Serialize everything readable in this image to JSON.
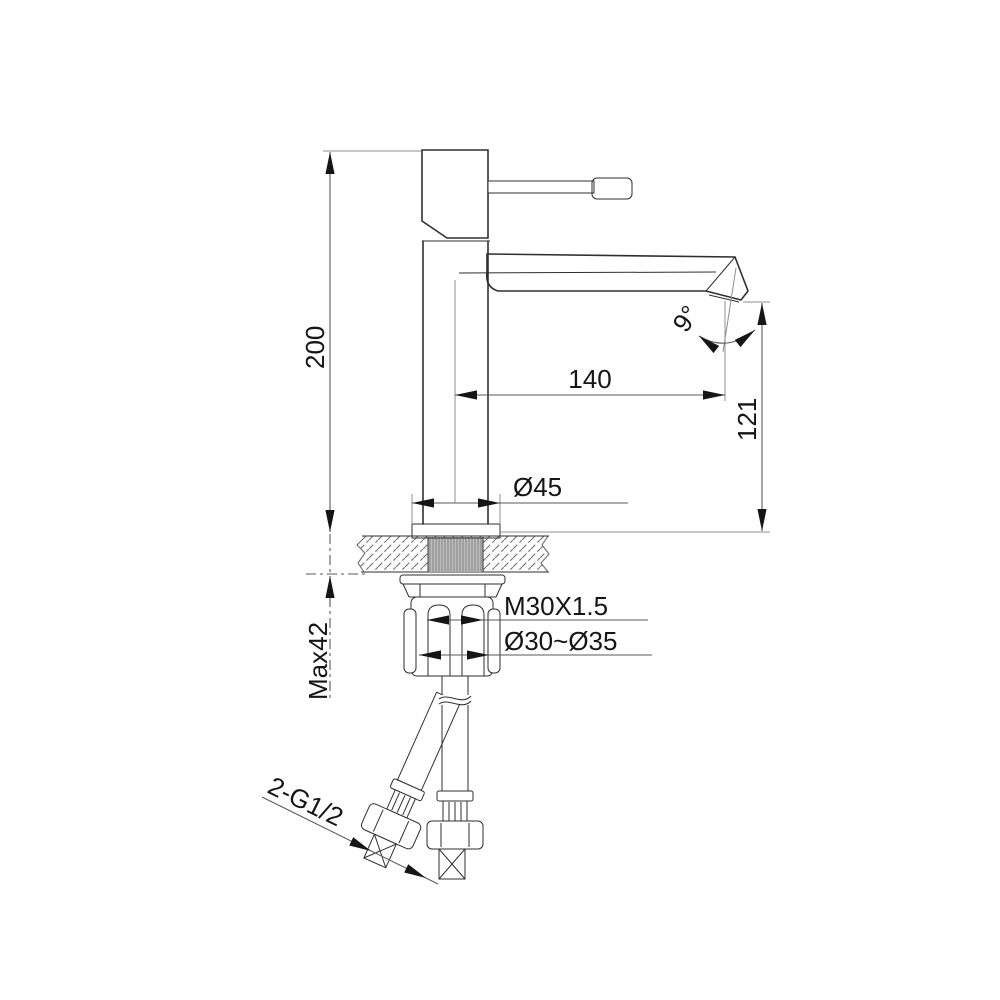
{
  "drawing": {
    "type": "technical-diagram",
    "subject": "single-lever basin mixer faucet — side elevation installation drawing",
    "colors": {
      "background": "#ffffff",
      "outline": "#2f2f2f",
      "dim_line": "#5a5a5a",
      "text": "#151515"
    },
    "labels": {
      "height": "200",
      "reach": "140",
      "spout_height": "121",
      "angle": "9°",
      "base_diameter": "Ø45",
      "thread_spec": "M30X1.5",
      "hole_range": "Ø30~Ø35",
      "max_thickness": "Max42",
      "hose_connection": "2-G1/2"
    },
    "measurements": {
      "total_height_mm": 200,
      "spout_reach_mm": 140,
      "spout_height_mm": 121,
      "spout_angle_deg": 9,
      "base_diameter_mm": 45,
      "thread": "M30X1.5",
      "hole_min_mm": 30,
      "hole_max_mm": 35,
      "max_deck_thickness_mm": 42,
      "hose_thread": "2-G1/2"
    }
  }
}
